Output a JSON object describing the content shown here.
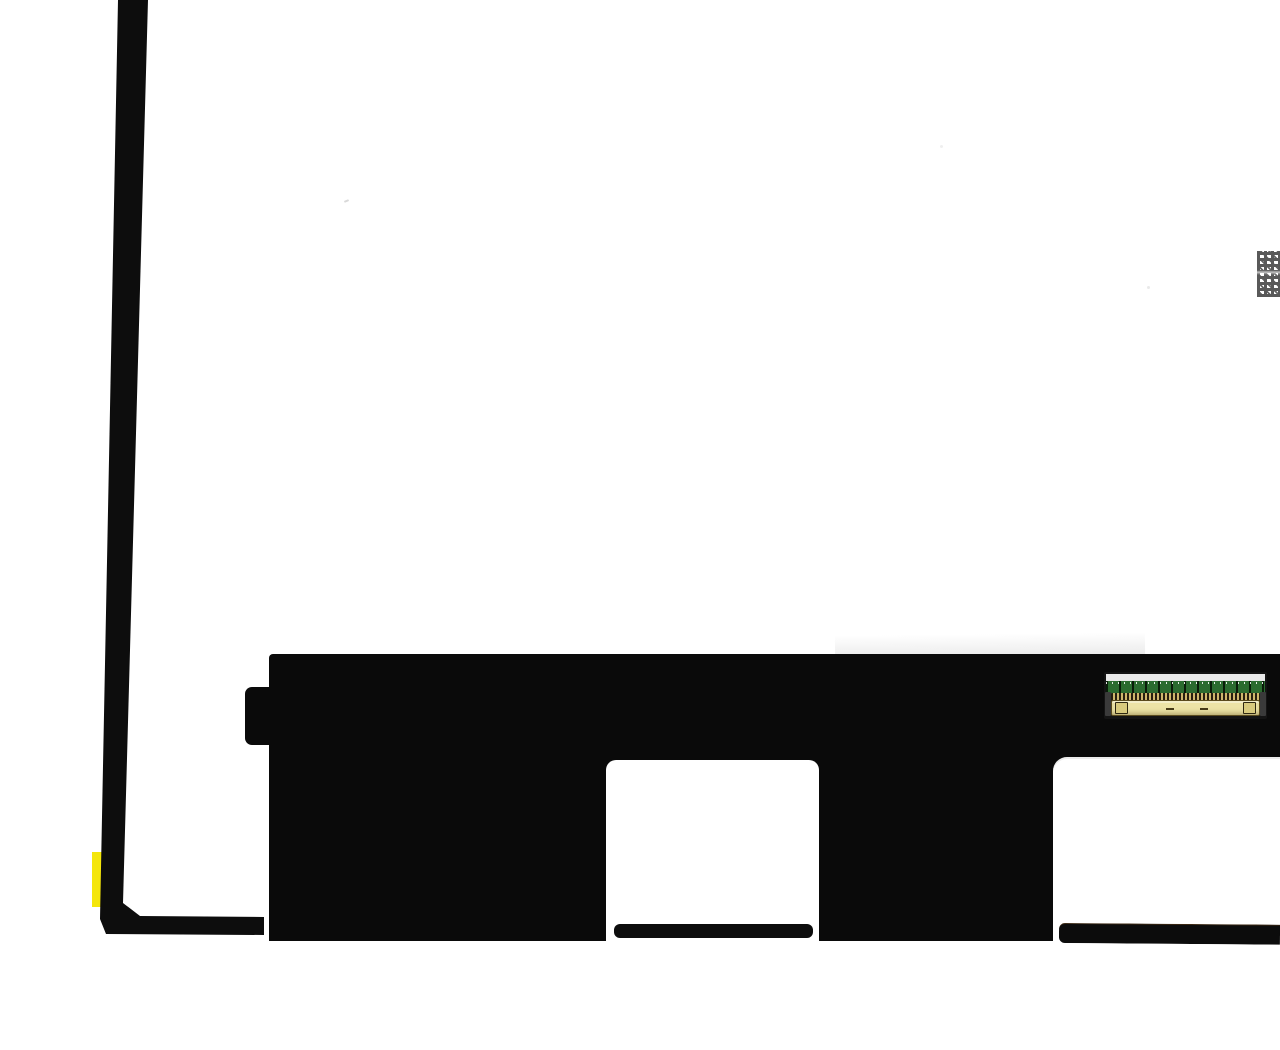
{
  "scene": {
    "type": "product-photo",
    "subject": "Rear view of a laptop LCD screen panel (bottom-left portion) on white background: black side edge strip, black bottom bracket with two cutouts, 30-pin video connector on green PCB, yellow tape marker near bottom-left corner, stamped datamatrix code at right edge",
    "background_color": "#ffffff"
  },
  "panel": {
    "left_edge_color": "#0d0d0d",
    "bracket_color": "#0a0a0a",
    "tape": {
      "color": "#f4e60b"
    },
    "connector": {
      "silkscreen_left": "N101",
      "silkscreen_right": "▼1",
      "pcb_color": "#2b6b2f",
      "body_color": "#ece3a6",
      "pins_gold": "#cdb76b",
      "pins_dark": "#261f10",
      "top_strip_color": "#eaeaea"
    },
    "datamatrix_color": "#3d3d3d"
  }
}
